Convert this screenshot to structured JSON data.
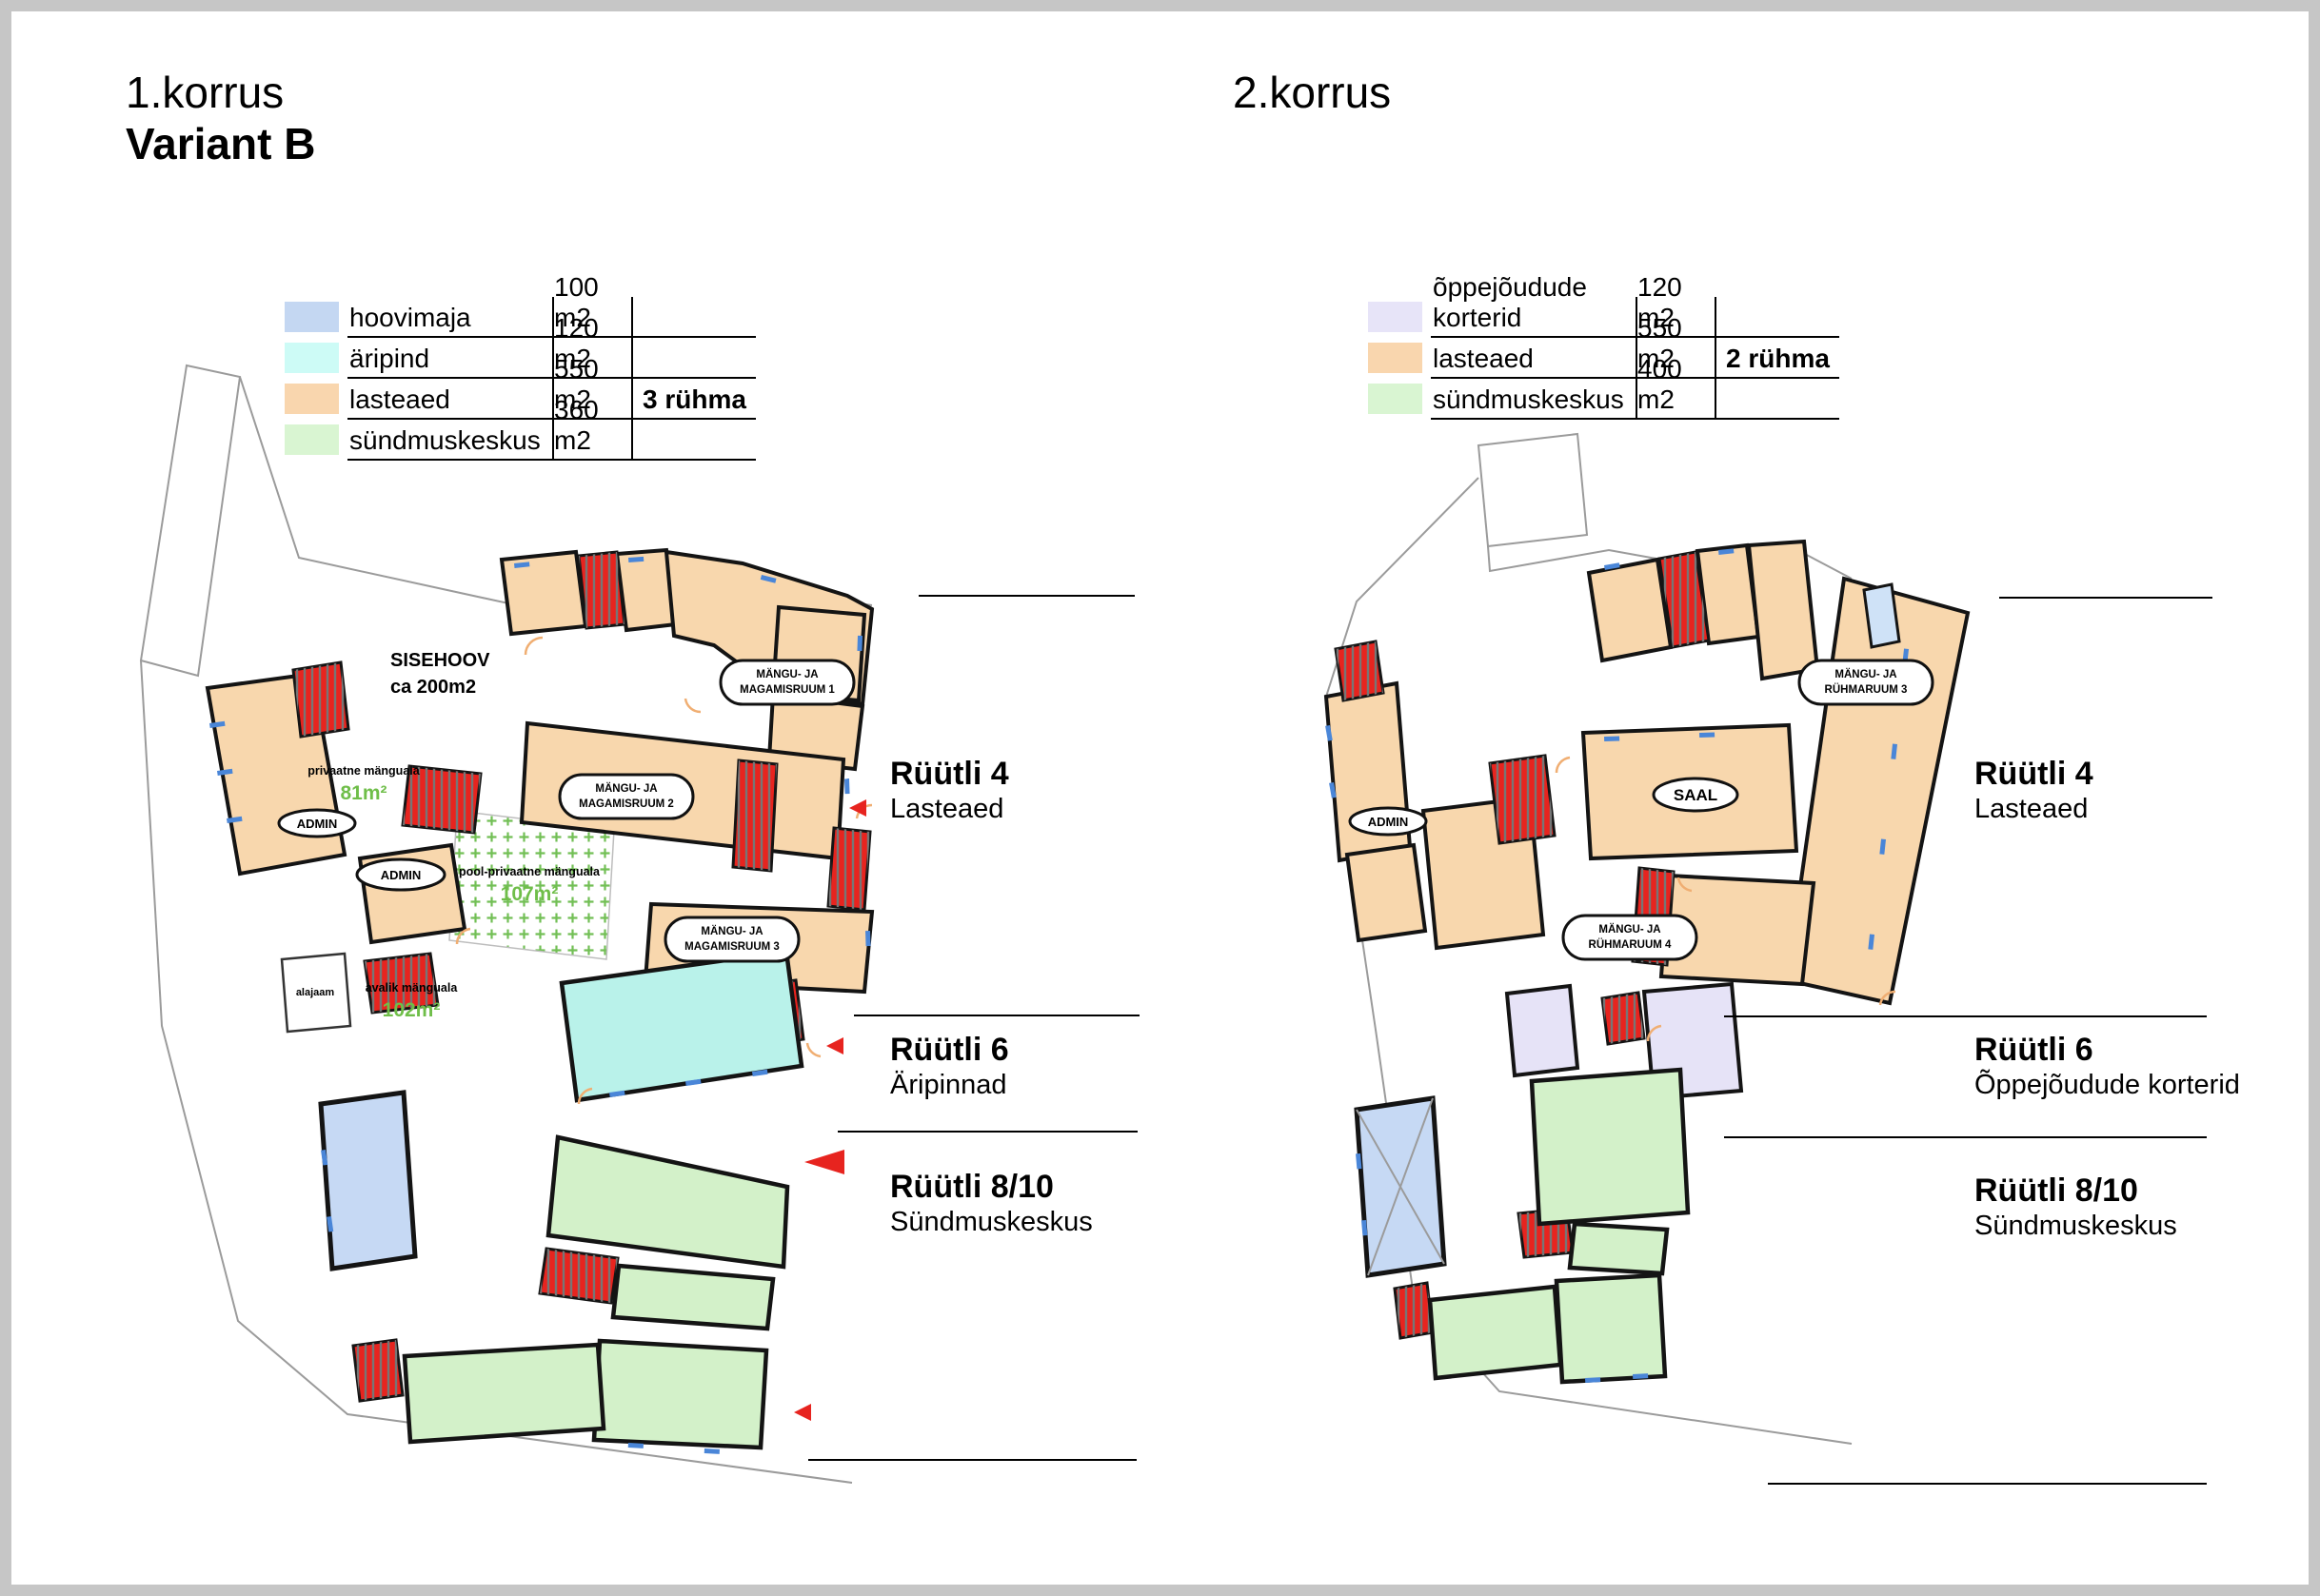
{
  "colors": {
    "tan": "#f8d7ad",
    "red": "#e7241f",
    "cyan": "#b9f2ea",
    "blue": "#c6d9f4",
    "green": "#d3f1c9",
    "lavender": "#e6e3f7",
    "lightblue": "#cfe2f7",
    "window": "#4a86d8",
    "door": "#f0ae72",
    "greentext": "#6fbe49",
    "sw_hoovimaja": "#c4d7f2",
    "sw_aripind": "#cdfbf6",
    "sw_lasteaed": "#f9d6ae",
    "sw_sundmus": "#d9f5d2",
    "sw_oppe": "#e7e4f8"
  },
  "floor1": {
    "title": "1.korrus",
    "subtitle": "Variant B",
    "legend": [
      {
        "label": "hoovimaja",
        "area": "100 m2",
        "note": ""
      },
      {
        "label": "äripind",
        "area": "120 m2",
        "note": ""
      },
      {
        "label": "lasteaed",
        "area": "550 m2",
        "note": "3 rühma"
      },
      {
        "label": "sündmuskeskus",
        "area": "360 m2",
        "note": ""
      }
    ],
    "streets": [
      {
        "name": "Rüütli 4",
        "use": "Lasteaed"
      },
      {
        "name": "Rüütli 6",
        "use": "Äripinnad"
      },
      {
        "name": "Rüütli 8/10",
        "use": "Sündmuskeskus"
      }
    ],
    "plan": {
      "sisehoov1": "SISEHOOV",
      "sisehoov2": "ca 200m2",
      "admin": "ADMIN",
      "bubble_line1": "MÄNGU- JA",
      "m1_line2": "MAGAMISRUUM 1",
      "m2_line2": "MAGAMISRUUM 2",
      "m3_line2": "MAGAMISRUUM 3",
      "priv1": "privaatne mänguala",
      "priv2": "81m²",
      "pool1": "pool-privaatne mänguala",
      "pool2": "107m²",
      "avalik1": "avalik mänguala",
      "avalik2": "102m²",
      "alajaam": "alajaam"
    }
  },
  "floor2": {
    "title": "2.korrus",
    "legend": [
      {
        "label": "õppejõudude korterid",
        "area": "120 m2",
        "note": ""
      },
      {
        "label": "lasteaed",
        "area": "550 m2",
        "note": "2 rühma"
      },
      {
        "label": "sündmuskeskus",
        "area": "400 m2",
        "note": ""
      }
    ],
    "streets": [
      {
        "name": "Rüütli 4",
        "use": "Lasteaed"
      },
      {
        "name": "Rüütli 6",
        "use": "Õppejõudude korterid"
      },
      {
        "name": "Rüütli 8/10",
        "use": "Sündmuskeskus"
      }
    ],
    "plan": {
      "admin": "ADMIN",
      "saal": "SAAL",
      "bubble_line1": "MÄNGU- JA",
      "r3_line2": "RÜHMARUUM 3",
      "r4_line2": "RÜHMARUUM 4"
    }
  }
}
